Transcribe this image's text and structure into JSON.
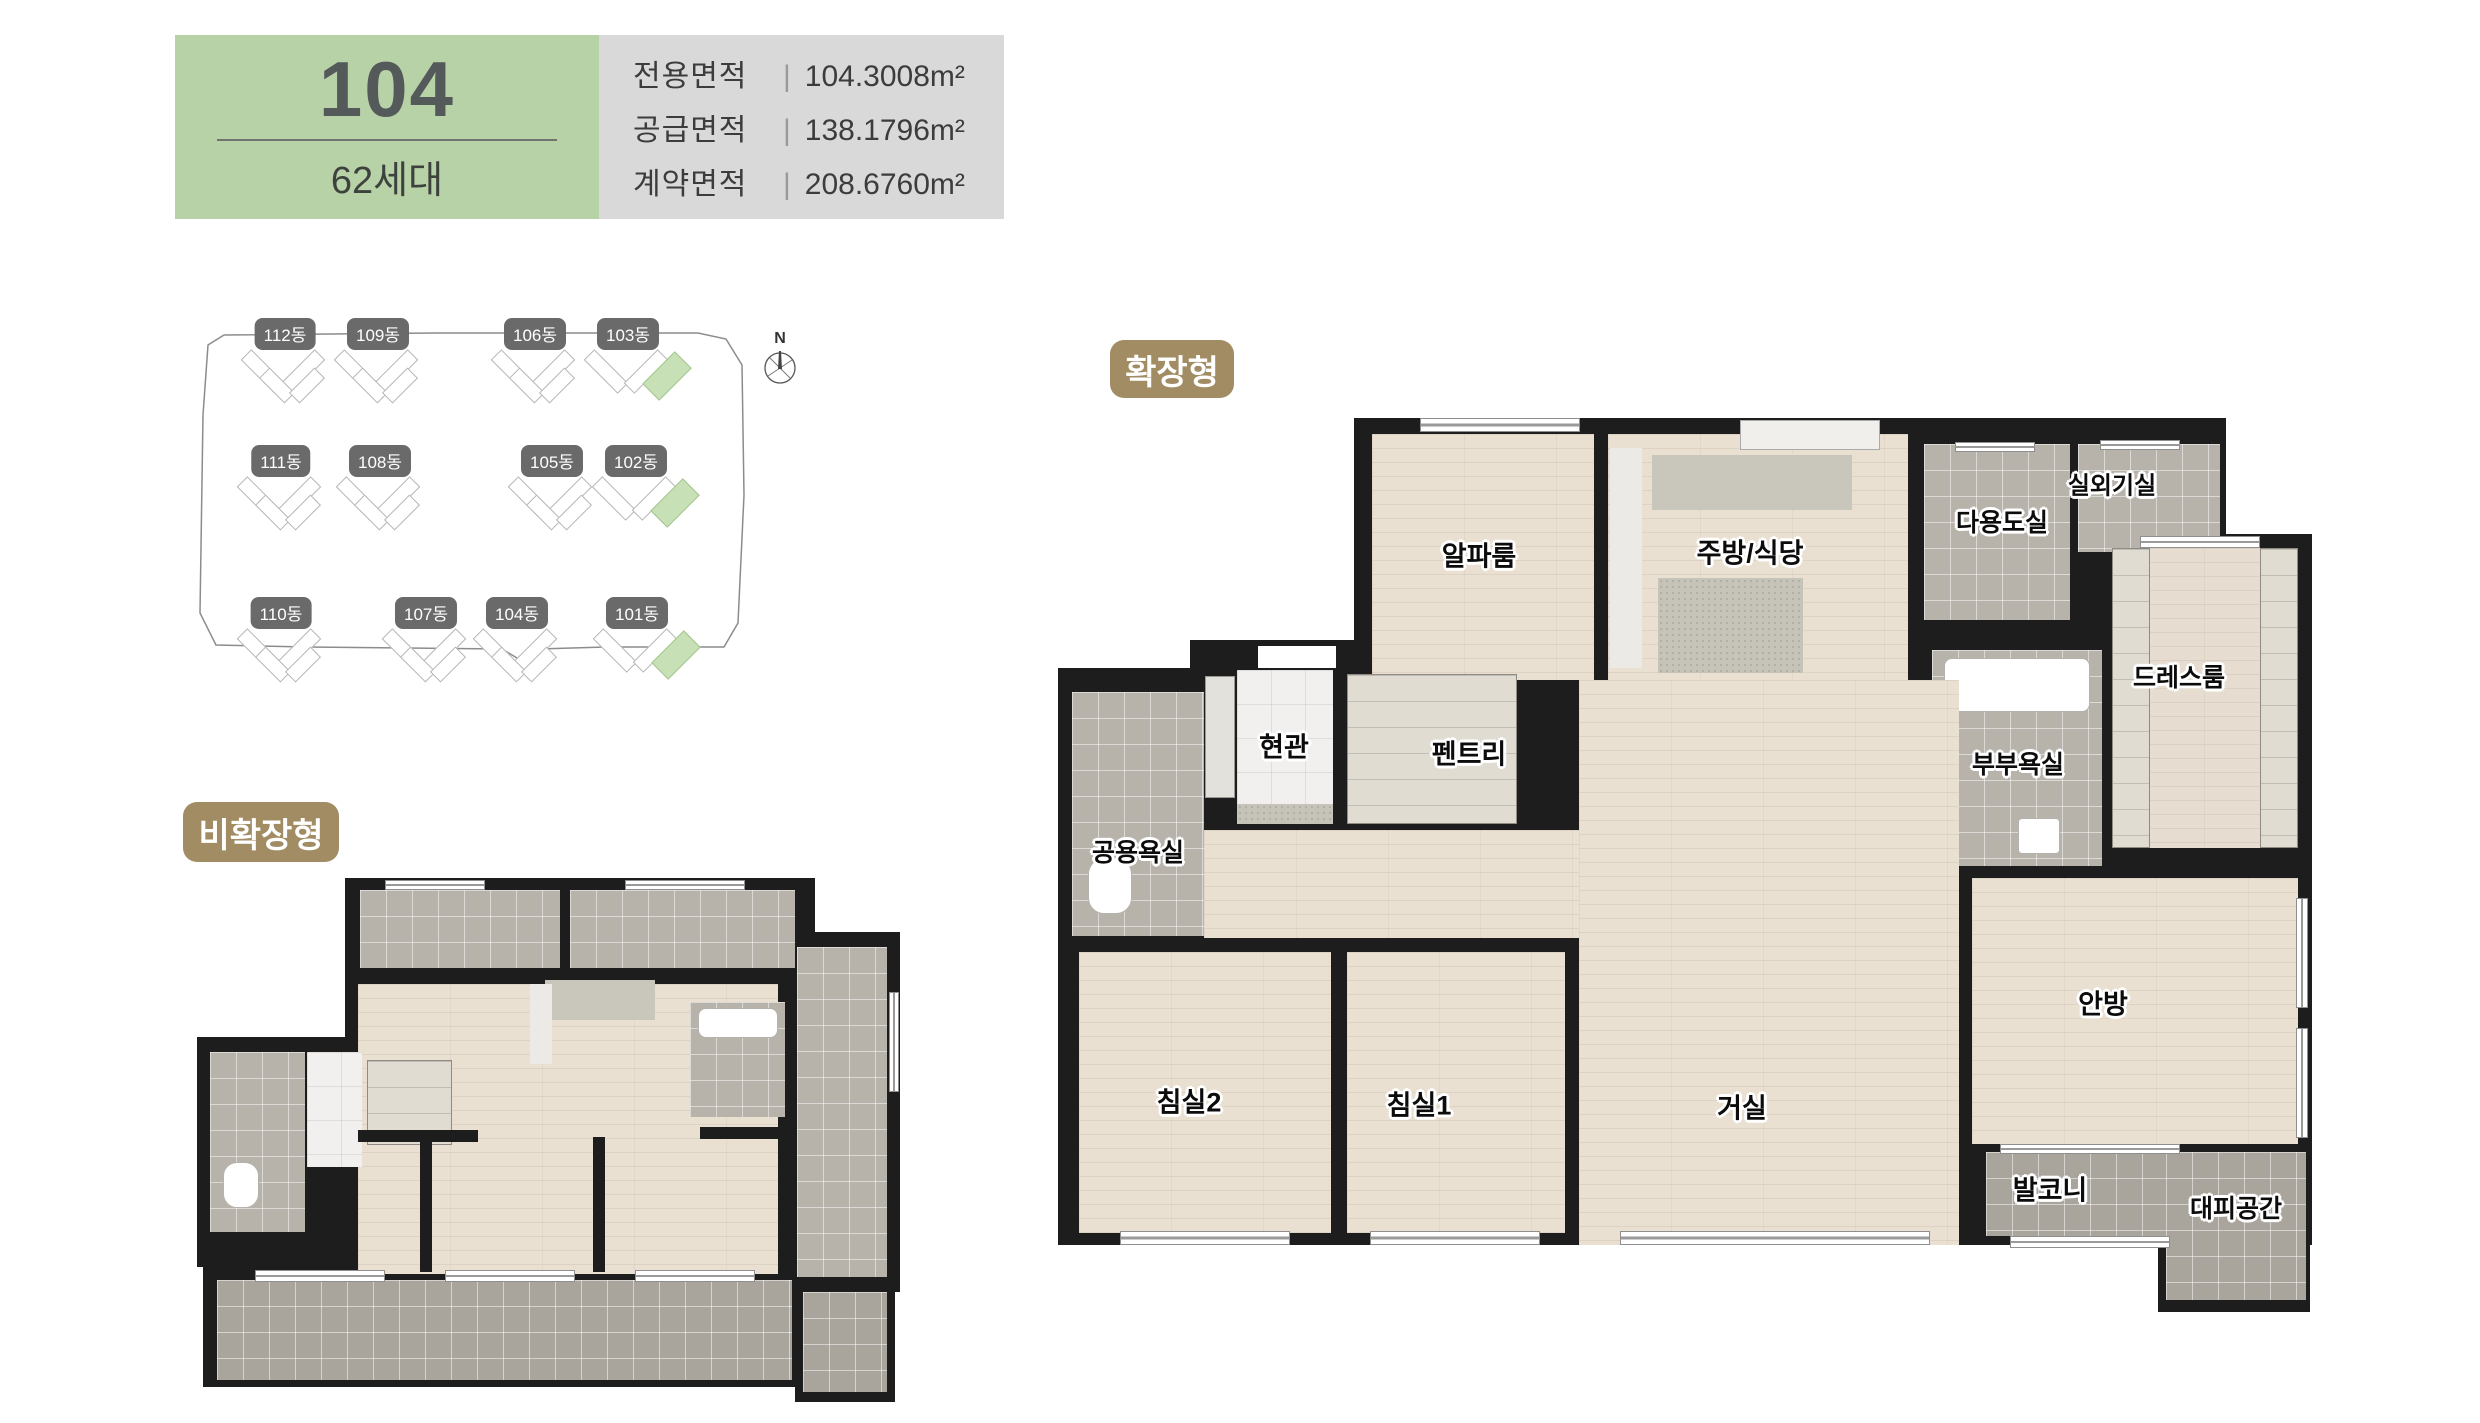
{
  "header": {
    "unit_type": "104",
    "household_count": "62세대",
    "area_divider": "|",
    "areas": [
      {
        "label": "전용면적",
        "value": "104.3008m²"
      },
      {
        "label": "공급면적",
        "value": "138.1796m²"
      },
      {
        "label": "계약면적",
        "value": "208.6760m²"
      }
    ]
  },
  "site_plan": {
    "compass_label": "N",
    "buildings": [
      {
        "label": "112동",
        "highlight": false
      },
      {
        "label": "109동",
        "highlight": false
      },
      {
        "label": "106동",
        "highlight": false
      },
      {
        "label": "103동",
        "highlight": true
      },
      {
        "label": "111동",
        "highlight": false
      },
      {
        "label": "108동",
        "highlight": false
      },
      {
        "label": "105동",
        "highlight": false
      },
      {
        "label": "102동",
        "highlight": true
      },
      {
        "label": "110동",
        "highlight": false
      },
      {
        "label": "107동",
        "highlight": false
      },
      {
        "label": "104동",
        "highlight": false
      },
      {
        "label": "101동",
        "highlight": true
      }
    ]
  },
  "plans": {
    "expanded": {
      "badge": "확장형",
      "rooms": [
        {
          "name": "alpha-room",
          "label": "알파룸"
        },
        {
          "name": "kitchen-dining",
          "label": "주방/식당"
        },
        {
          "name": "utility-room",
          "label": "다용도실"
        },
        {
          "name": "ac-outdoor-unit-room",
          "label": "실외기실"
        },
        {
          "name": "dress-room",
          "label": "드레스룸"
        },
        {
          "name": "master-bathroom",
          "label": "부부욕실"
        },
        {
          "name": "entrance",
          "label": "현관"
        },
        {
          "name": "pantry",
          "label": "펜트리"
        },
        {
          "name": "common-bathroom",
          "label": "공용욕실"
        },
        {
          "name": "bedroom2",
          "label": "침실2"
        },
        {
          "name": "bedroom1",
          "label": "침실1"
        },
        {
          "name": "living-room",
          "label": "거실"
        },
        {
          "name": "master-bedroom",
          "label": "안방"
        },
        {
          "name": "balcony",
          "label": "발코니"
        },
        {
          "name": "evacuation-space",
          "label": "대피공간"
        }
      ]
    },
    "non_expanded": {
      "badge": "비확장형"
    }
  },
  "colors": {
    "accent_green": "#b8d2a7",
    "panel_gray": "#d9d9d9",
    "badge_brown": "#a28c64",
    "highlight_green": "#c8e0b5",
    "wall_dark": "#1d1d1d",
    "floor_beige": "#e9e0d2",
    "tile_gray": "#b7b2aa"
  }
}
